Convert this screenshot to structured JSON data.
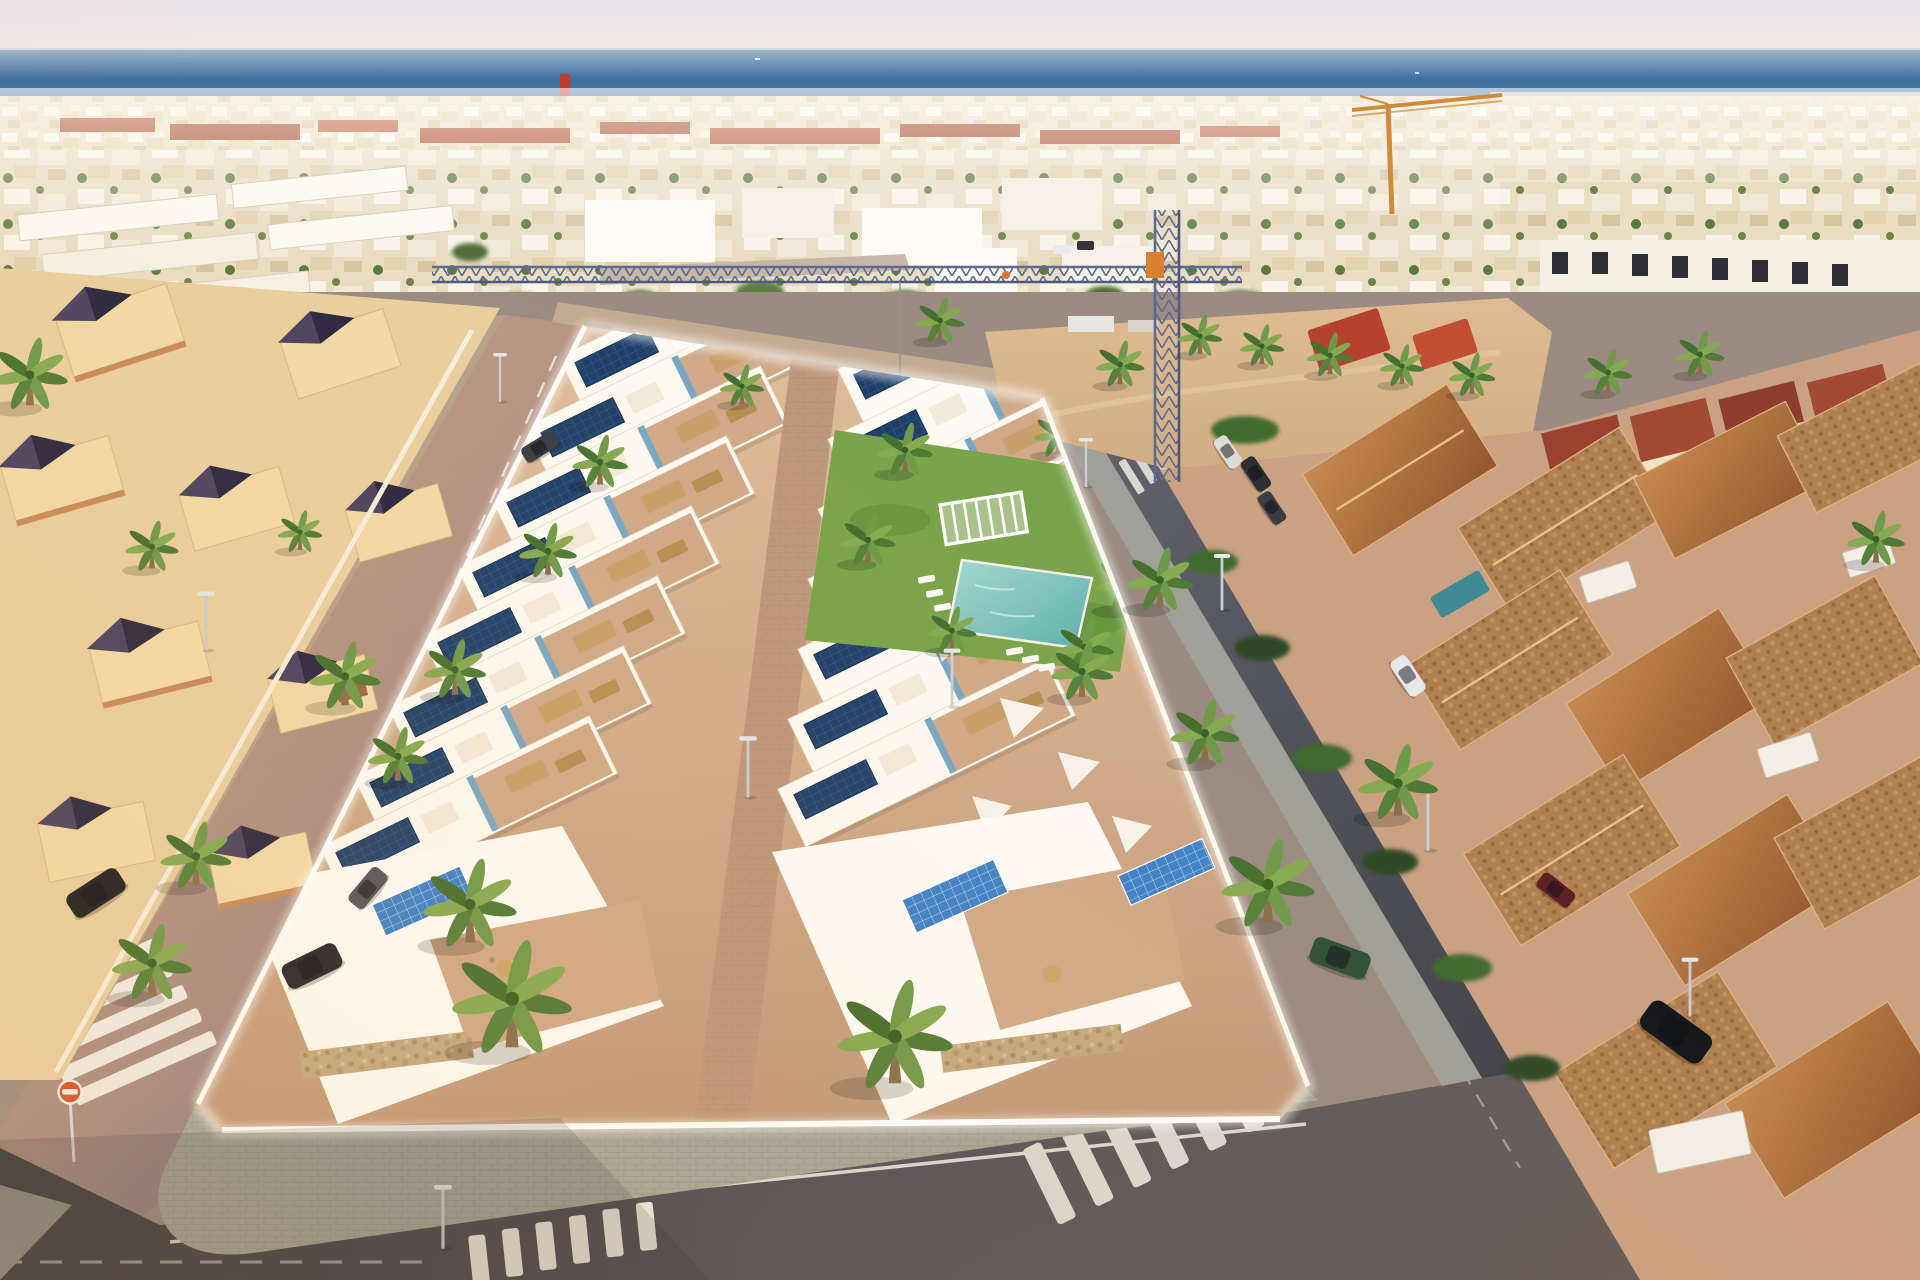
{
  "scene": {
    "type": "aerial-architectural-render",
    "description": "Golden-hour aerial drone view of a new-build block of white modern villas with rooftop solar panels, roof terraces and a communal lawn with pool, set inside an existing Mediterranean beach town with cream villas, terracotta townhouses, palm-lined streets, two construction cranes, a sandy vacant lot and the sea on the horizon.",
    "regions": {
      "sky": "pale hazy dawn sky",
      "sea": "deep blue sea band across the horizon",
      "distant_town": "dense low-rise beach town with red tiled roofs",
      "dirt_lot": "sandy vacant construction plot right of the blue crane",
      "new_development": "two diagonal strips of white villas with navy solar panels, central paved walkway, communal lawn, pergola and pool",
      "left_neighborhood": "cream villas with dark pyramid roofs",
      "right_neighborhood": "terracotta-roof townhouses with white dormers and red mono-pitch roofs",
      "streets": "sunlit street on the left, shaded streets on the right and bottom with zebra crossings"
    }
  },
  "palette": {
    "sky_top": "#e9e4ea",
    "sky_horizon": "#f1eae5",
    "sea_far": "#9eb7cd",
    "sea_deep": "#3f6f9e",
    "sea_near": "#7ba3c3",
    "distant_town": "#efe3cb",
    "red_roof": "#b1532f",
    "dirt_lot": "#d8b68c",
    "left_street": "#bd9581",
    "right_street": "#53545c",
    "bottom_street": "#47484f",
    "sidewalk": "#a5a699",
    "dev_wall": "#ffffff",
    "terrace": "#cfa988",
    "walkway": "#bf977b",
    "solar_navy": "#20406a",
    "solar_bright": "#3f82c8",
    "lawn": "#7aa44b",
    "pool": "#7cc4bc",
    "palm_green": "#5d8a3e",
    "palm_trunk": "#8a6f4e",
    "terracotta": "#b5773f",
    "cream_villa": "#f2d9a7",
    "dark_roof": "#332e46",
    "stone_wall": "#c3a97f",
    "crane_blue": "#5d6b92",
    "crane_orange": "#cf8b3a",
    "sign_orange": "#d94f2b"
  },
  "objects": {
    "cranes": [
      {
        "name": "blue tower crane",
        "color": "#5d6b92",
        "position": "center, jib spanning the development"
      },
      {
        "name": "orange crane",
        "color": "#cf8b3a",
        "position": "top right near shoreline"
      }
    ],
    "cars": [
      {
        "color": "black",
        "location": "left street, parked"
      },
      {
        "color": "dark grey",
        "location": "upper left street"
      },
      {
        "color": "dark",
        "location": "mid-ground street"
      },
      {
        "color": "dark",
        "location": "development corner drive"
      },
      {
        "color": "grey",
        "location": "left street lower"
      },
      {
        "color": "white",
        "location": "right street, driving"
      },
      {
        "color": "white van",
        "location": "right street upper"
      },
      {
        "color": "dark SUV",
        "location": "right street upper"
      },
      {
        "color": "dark",
        "location": "right street mid"
      },
      {
        "color": "black sedan",
        "location": "bottom right street, parked"
      },
      {
        "color": "dark green coupe",
        "location": "development driveway bottom right"
      },
      {
        "color": "dark red",
        "location": "top of bottom-right street"
      }
    ],
    "traffic_sign": {
      "shape": "circle",
      "color": "#d94f2b",
      "location": "bottom left corner"
    },
    "crosswalks": 5,
    "street_lamps": 9,
    "palm_trees": 36,
    "solar_panel_arrays": 18,
    "communal_pool": 1,
    "pergola": 1
  }
}
